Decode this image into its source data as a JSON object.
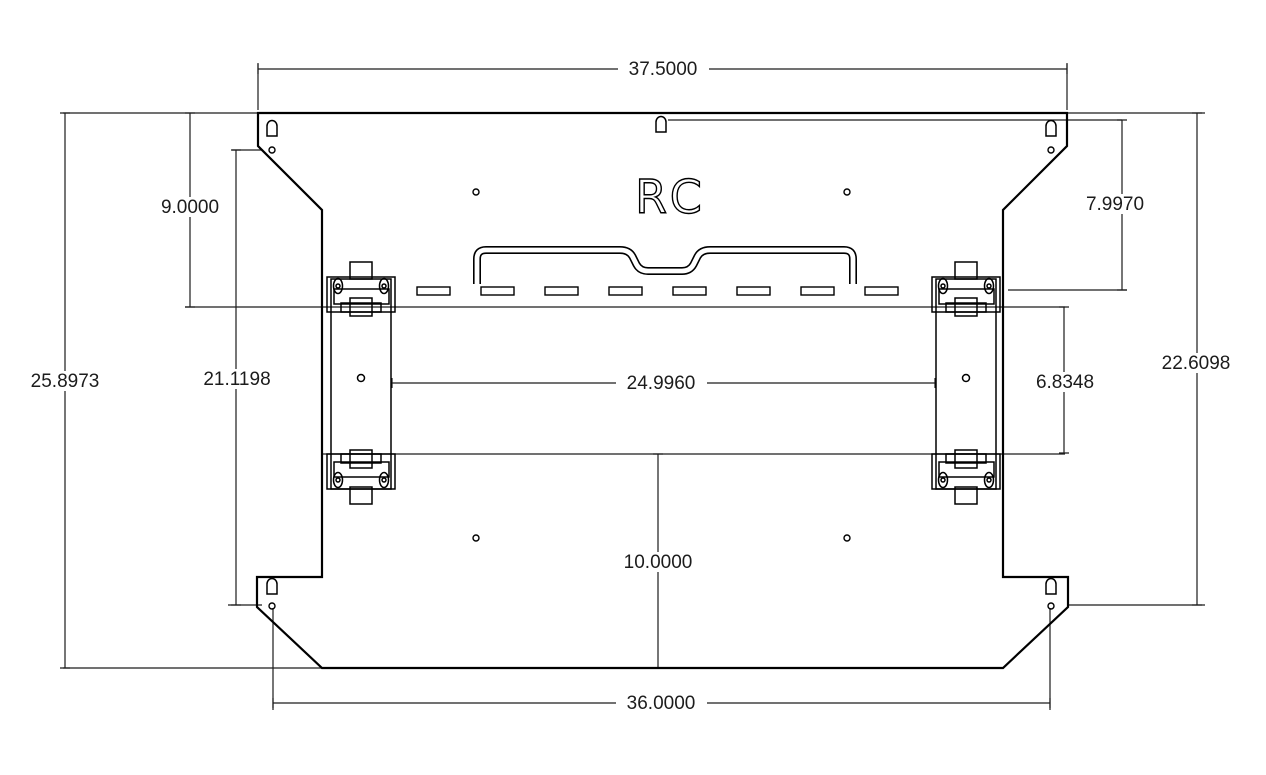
{
  "drawing": {
    "logo": "RC",
    "dimensions": {
      "top_width": "37.5000",
      "overall_height_left": "25.8973",
      "upper_left_offset": "9.0000",
      "inner_height_left": "21.1198",
      "bracket_span": "24.9960",
      "spacer_height_right": "6.8348",
      "upper_right_offset": "7.9970",
      "overall_height_right": "22.6098",
      "lower_center_height": "10.0000",
      "bottom_width": "36.0000"
    }
  }
}
